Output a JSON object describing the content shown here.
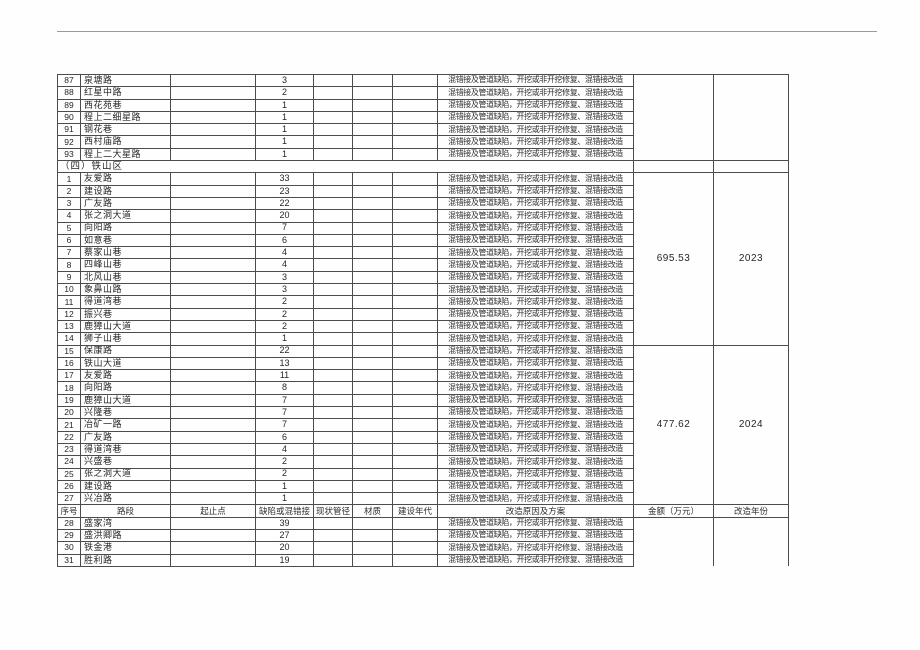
{
  "table": {
    "columns": [
      "序号",
      "路段",
      "起止点",
      "缺陷或混错接",
      "现状管径",
      "材质",
      "建设年代",
      "改造原因及方案",
      "金额（万元）",
      "改造年份"
    ],
    "remediation_text": "混错接及管道缺陷，开挖或非开挖修复、混错接改造",
    "blocks": [
      {
        "type": "rows",
        "amount": "",
        "year": "",
        "open_bottom": false,
        "rows": [
          [
            "87",
            "泉塘路",
            "3"
          ],
          [
            "88",
            "红星中路",
            "2"
          ],
          [
            "89",
            "西花苑巷",
            "1"
          ],
          [
            "90",
            "程上二细星路",
            "1"
          ],
          [
            "91",
            "钢花巷",
            "1"
          ],
          [
            "92",
            "西村庙路",
            "1"
          ],
          [
            "93",
            "程上二大星路",
            "1"
          ]
        ]
      },
      {
        "type": "section",
        "label": "（四）铁山区"
      },
      {
        "type": "rows",
        "amount": "695.53",
        "year": "2023",
        "open_bottom": false,
        "rows": [
          [
            "1",
            "友爱路",
            "33"
          ],
          [
            "2",
            "建设路",
            "23"
          ],
          [
            "3",
            "广友路",
            "22"
          ],
          [
            "4",
            "张之洞大道",
            "20"
          ],
          [
            "5",
            "向阳路",
            "7"
          ],
          [
            "6",
            "如意巷",
            "6"
          ],
          [
            "7",
            "蔡家山巷",
            "4"
          ],
          [
            "8",
            "四峰山巷",
            "4"
          ],
          [
            "9",
            "北风山巷",
            "3"
          ],
          [
            "10",
            "象鼻山路",
            "3"
          ],
          [
            "11",
            "得道湾巷",
            "2"
          ],
          [
            "12",
            "振兴巷",
            "2"
          ],
          [
            "13",
            "鹿獐山大道",
            "2"
          ],
          [
            "14",
            "狮子山巷",
            "1"
          ]
        ]
      },
      {
        "type": "rows",
        "amount": "477.62",
        "year": "2024",
        "open_bottom": false,
        "rows": [
          [
            "15",
            "保康路",
            "22"
          ],
          [
            "16",
            "铁山大道",
            "13"
          ],
          [
            "17",
            "友爱路",
            "11"
          ],
          [
            "18",
            "向阳路",
            "8"
          ],
          [
            "19",
            "鹿獐山大道",
            "7"
          ],
          [
            "20",
            "兴隆巷",
            "7"
          ],
          [
            "21",
            "冶矿一路",
            "7"
          ],
          [
            "22",
            "广友路",
            "6"
          ],
          [
            "23",
            "得道湾巷",
            "4"
          ],
          [
            "24",
            "兴盛巷",
            "2"
          ],
          [
            "25",
            "张之洞大道",
            "2"
          ],
          [
            "26",
            "建设路",
            "1"
          ],
          [
            "27",
            "兴冶路",
            "1"
          ]
        ]
      },
      {
        "type": "header"
      },
      {
        "type": "rows",
        "amount": "",
        "year": "",
        "open_bottom": true,
        "rows": [
          [
            "28",
            "盛家湾",
            "39"
          ],
          [
            "29",
            "盛洪卿路",
            "27"
          ],
          [
            "30",
            "铁金港",
            "20"
          ],
          [
            "31",
            "胜利路",
            "19"
          ]
        ]
      }
    ]
  }
}
